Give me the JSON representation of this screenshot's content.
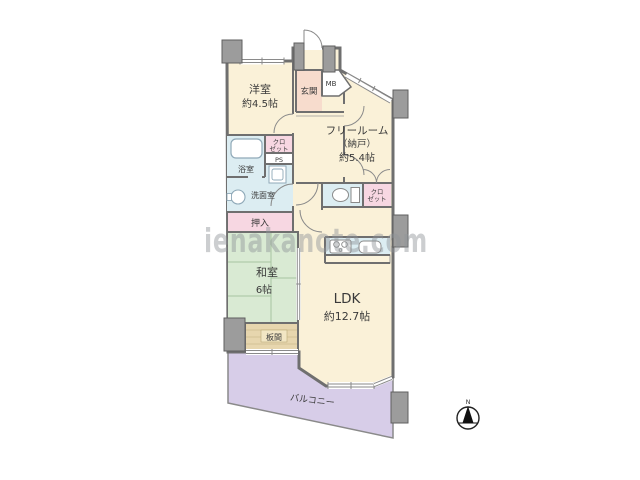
{
  "plan": {
    "watermark": "ienakanote.com",
    "rooms": {
      "yoshitsu": {
        "name": "洋室",
        "size": "約4.5帖"
      },
      "genkan": {
        "name": "玄関"
      },
      "mb": {
        "name": "MB"
      },
      "freeroom": {
        "name": "フリールーム",
        "name2": "（納戸）",
        "size": "約5.4帖"
      },
      "closet_left": {
        "line1": "クロ",
        "line2": "ゼット"
      },
      "ps": {
        "name": "PS"
      },
      "bathroom": {
        "name": "浴室"
      },
      "washroom": {
        "name": "洗面室"
      },
      "oshiire": {
        "name": "押入"
      },
      "washitsu": {
        "name": "和室",
        "size": "6帖"
      },
      "itanoma": {
        "name": "板間"
      },
      "ldk": {
        "name": "LDK",
        "size": "約12.7帖"
      },
      "closet_right": {
        "line1": "クロ",
        "line2": "ゼット"
      },
      "balcony": {
        "name": "バルコニー"
      }
    },
    "compass": {
      "north_label": "N"
    },
    "colors": {
      "room_cream": "#FAF1D8",
      "entry_pink": "#F7DCCD",
      "closet_pink": "#F7D7E2",
      "tatami_green": "#D9EAD3",
      "wet_area_blue": "#DCEDF2",
      "balcony_purple": "#D7CDE8",
      "wood_tan": "#E7D6AE",
      "wall_gray": "#6F6F6F",
      "pillar_gray": "#9C9C9C"
    }
  }
}
